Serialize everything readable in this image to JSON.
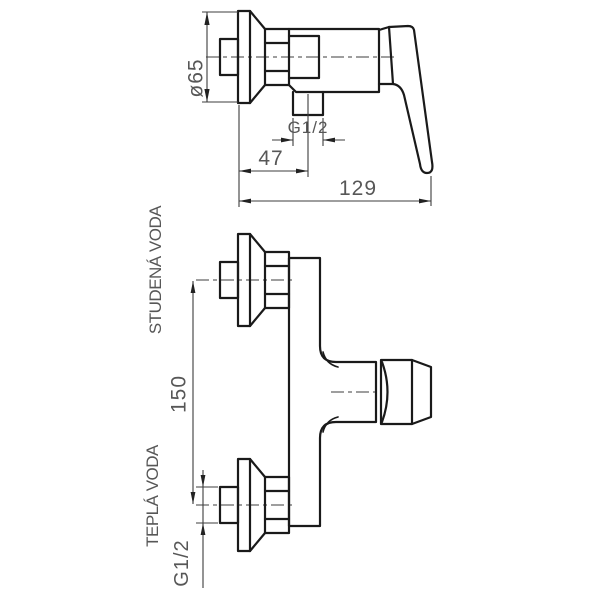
{
  "drawing": {
    "kind": "technical-drawing",
    "colors": {
      "background": "#ffffff",
      "outline": "#1a1a1a",
      "dimension_lines": "#3d3d3d",
      "text": "#575757"
    },
    "side_view": {
      "dim_flange_diameter": "ø65",
      "dim_outlet_thread": "G1/2",
      "dim_wall_to_outlet": "47",
      "dim_total_depth": "129"
    },
    "front_view": {
      "label_cold_water": "STUDENÁ VODA",
      "label_hot_water": "TEPLÁ VODA",
      "dim_connection_spacing": "150",
      "dim_inlet_thread": "G1/2"
    }
  }
}
